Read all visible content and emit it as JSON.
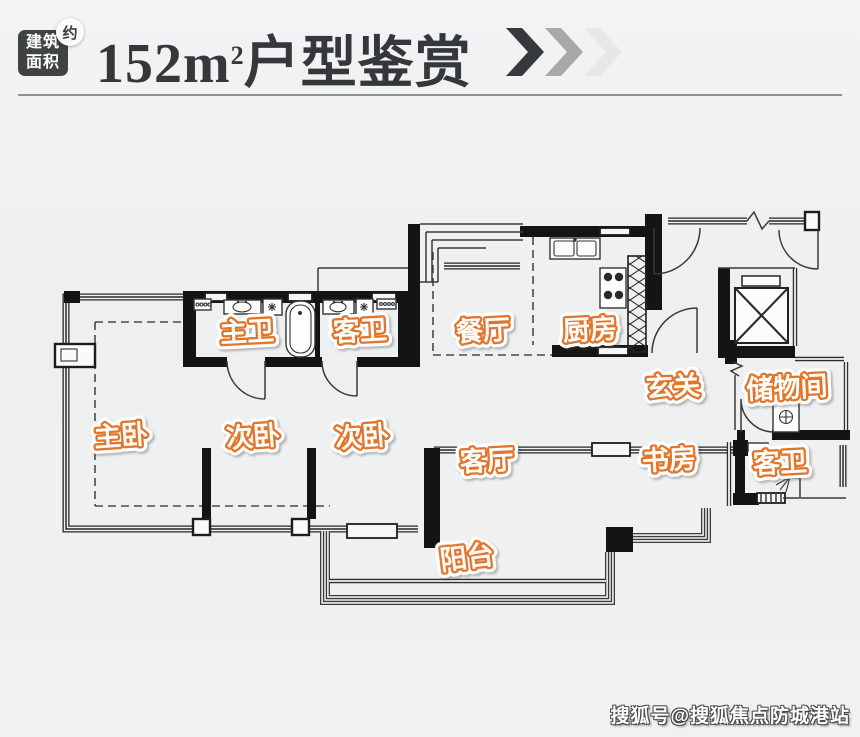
{
  "header": {
    "badge": {
      "line1": "建筑",
      "line2": "面积",
      "approx": "约"
    },
    "title": {
      "area_number": "152",
      "area_unit": "m",
      "area_sup": "2",
      "suffix": "户型鉴赏"
    }
  },
  "floorplan": {
    "rooms": [
      {
        "id": "master-bath",
        "label": "主卫"
      },
      {
        "id": "guest-bath-top",
        "label": "客卫"
      },
      {
        "id": "dining-room",
        "label": "餐厅"
      },
      {
        "id": "kitchen",
        "label": "厨房"
      },
      {
        "id": "foyer",
        "label": "玄关"
      },
      {
        "id": "storage-room",
        "label": "储物间"
      },
      {
        "id": "master-bedroom",
        "label": "主卧"
      },
      {
        "id": "bedroom-2",
        "label": "次卧"
      },
      {
        "id": "bedroom-3",
        "label": "次卧"
      },
      {
        "id": "living-room",
        "label": "客厅"
      },
      {
        "id": "study",
        "label": "书房"
      },
      {
        "id": "guest-bath-bottom",
        "label": "客卫"
      },
      {
        "id": "balcony",
        "label": "阳台"
      }
    ]
  },
  "watermark": {
    "text": "搜狐号@搜狐焦点防城港站"
  },
  "colors": {
    "label_accent": "#e2742c",
    "label_fill": "#fffdf8",
    "title_text": "#34383a",
    "badge_bg": "#3f4442",
    "chevrons": [
      "#35393b",
      "#a7a9a9",
      "#e6e7e7"
    ]
  }
}
